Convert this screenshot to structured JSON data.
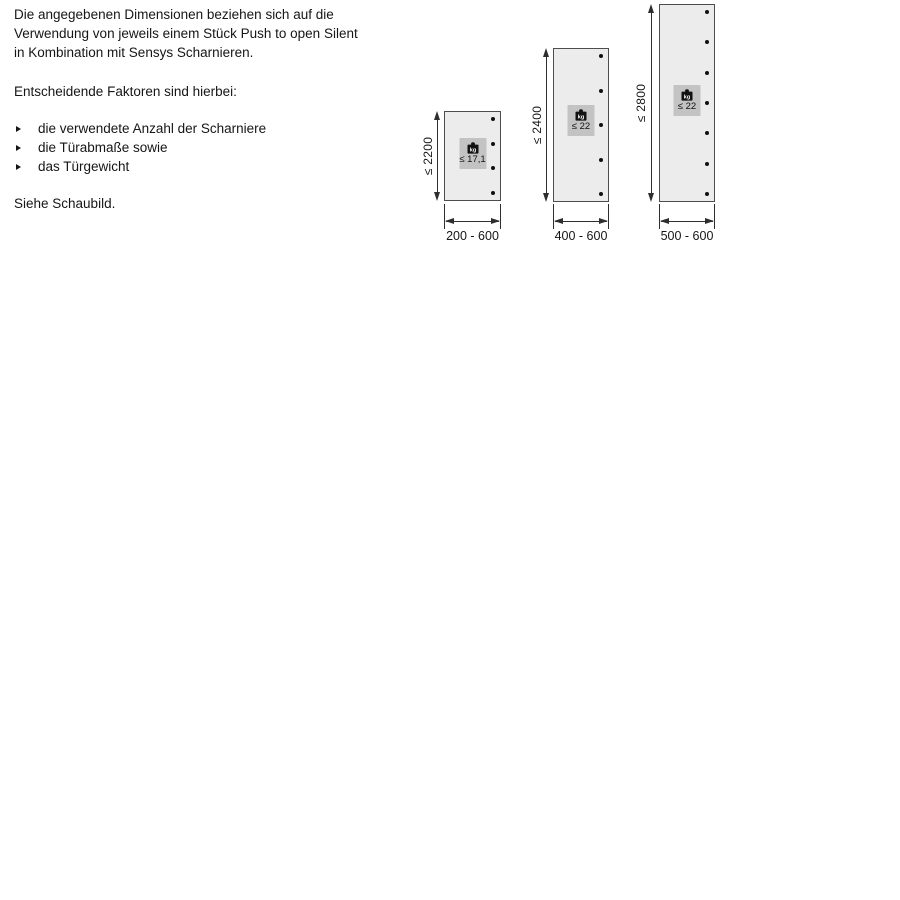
{
  "intro": {
    "lines": [
      "Die angegebenen Dimensionen beziehen sich auf die",
      "Verwendung von jeweils einem Stück Push to open Silent",
      "in Kombination mit Sensys Scharnieren."
    ],
    "factors_heading": "Entscheidende Faktoren sind hierbei:",
    "factors": [
      "die verwendete Anzahl der Scharniere",
      "die Türabmaße sowie",
      "das Türgewicht"
    ],
    "see_note": "Siehe Schaubild."
  },
  "diagrams": [
    {
      "name": "door-small",
      "height_label": "≤ 2200",
      "weight_unit": "kg",
      "weight_label": "≤ 17,1",
      "width_label": "200 - 600",
      "hinge_count": 4
    },
    {
      "name": "door-medium",
      "height_label": "≤ 2400",
      "weight_unit": "kg",
      "weight_label": "≤ 22",
      "width_label": "400 - 600",
      "hinge_count": 5
    },
    {
      "name": "door-tall",
      "height_label": "≤ 2800",
      "weight_unit": "kg",
      "weight_label": "≤ 22",
      "width_label": "500 - 600",
      "hinge_count": 7
    }
  ],
  "colors": {
    "door_fill": "#ececec",
    "door_border": "#4d4d4d",
    "badge_fill": "#c3c3c3",
    "line": "#2e2e2e",
    "text": "#161616"
  }
}
